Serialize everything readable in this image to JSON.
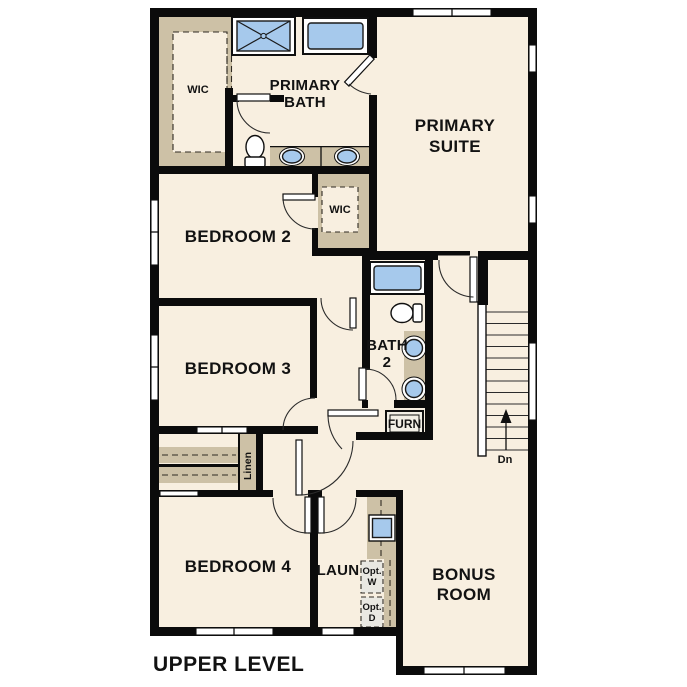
{
  "title": "UPPER LEVEL",
  "colors": {
    "wall": "#0b0b0b",
    "floor": "#f8efe0",
    "closet": "#cdc1a6",
    "fixture": "#a6c9ec",
    "appliance": "#e9e8e2",
    "bg": "#ffffff",
    "line": "#2b2b2b"
  },
  "rooms": {
    "primary_suite": {
      "line1": "PRIMARY",
      "line2": "SUITE"
    },
    "primary_bath": {
      "line1": "PRIMARY",
      "line2": "BATH"
    },
    "wic_primary": "WIC",
    "bedroom2": "BEDROOM 2",
    "wic_bedroom2": "WIC",
    "bedroom3": "BEDROOM 3",
    "bath2": {
      "line1": "BATH",
      "line2": "2"
    },
    "furnace": "FURN",
    "linen": "Linen",
    "bedroom4": "BEDROOM 4",
    "laundry": "LAUN",
    "opt_washer": {
      "line1": "Opt.",
      "line2": "W"
    },
    "opt_dryer": {
      "line1": "Opt.",
      "line2": "D"
    },
    "bonus_room": {
      "line1": "BONUS",
      "line2": "ROOM"
    },
    "stairs_down": "Dn"
  }
}
